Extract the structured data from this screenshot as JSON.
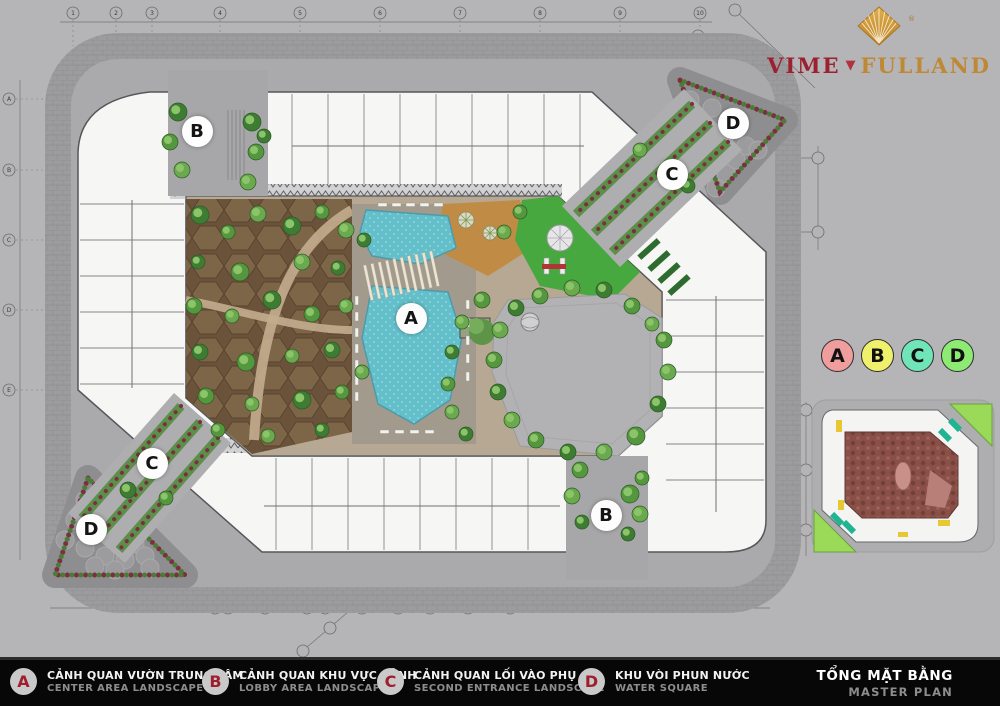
{
  "page": {
    "background": "#b5b5b7",
    "bar_background": "#070707"
  },
  "logo": {
    "brand_left": "VIME",
    "brand_right": "FULLAND",
    "registered": "®",
    "color_left": "#9c2030",
    "color_right": "#bf8834",
    "icon": "gold-diamond-fan"
  },
  "plan": {
    "markers": [
      {
        "label": "B",
        "x": 197,
        "y": 131
      },
      {
        "label": "D",
        "x": 733,
        "y": 123
      },
      {
        "label": "C",
        "x": 672,
        "y": 174
      },
      {
        "label": "A",
        "x": 411,
        "y": 318
      },
      {
        "label": "C",
        "x": 152,
        "y": 463
      },
      {
        "label": "D",
        "x": 91,
        "y": 529
      },
      {
        "label": "B",
        "x": 606,
        "y": 515
      }
    ],
    "grid": {
      "top": [
        "1",
        "2",
        "3",
        "4",
        "5",
        "6",
        "7",
        "8",
        "9",
        "10"
      ],
      "left": [
        "A",
        "B",
        "C",
        "D",
        "E"
      ],
      "bottom": [
        "5",
        "6",
        "8",
        "7",
        "60",
        "9",
        "10",
        "11",
        "12",
        "13"
      ]
    }
  },
  "zone_chips": [
    {
      "label": "A",
      "color": "#ef9d9d"
    },
    {
      "label": "B",
      "color": "#eff06c"
    },
    {
      "label": "C",
      "color": "#70e6b8"
    },
    {
      "label": "D",
      "color": "#8deb74"
    }
  ],
  "legend": {
    "items": [
      {
        "key": "A",
        "title_vi": "CẢNH QUAN VƯỜN TRUNG TÂM",
        "title_en": "CENTER AREA LANDSCAPE",
        "x": 10
      },
      {
        "key": "B",
        "title_vi": "CẢNH QUAN KHU VỰC SẢNH",
        "title_en": "LOBBY AREA LANDSCAPE",
        "x": 202
      },
      {
        "key": "C",
        "title_vi": "CẢNH QUAN LỐI VÀO PHỤ",
        "title_en": "SECOND ENTRANCE LANDSCAPE",
        "x": 377
      },
      {
        "key": "D",
        "title_vi": "KHU VÒI PHUN NƯỚC",
        "title_en": "WATER SQUARE",
        "x": 578
      }
    ],
    "circle_letter_color": "#9e1f2e",
    "title_vi": "TỔNG MẶT BẰNG",
    "title_en": "MASTER PLAN"
  }
}
